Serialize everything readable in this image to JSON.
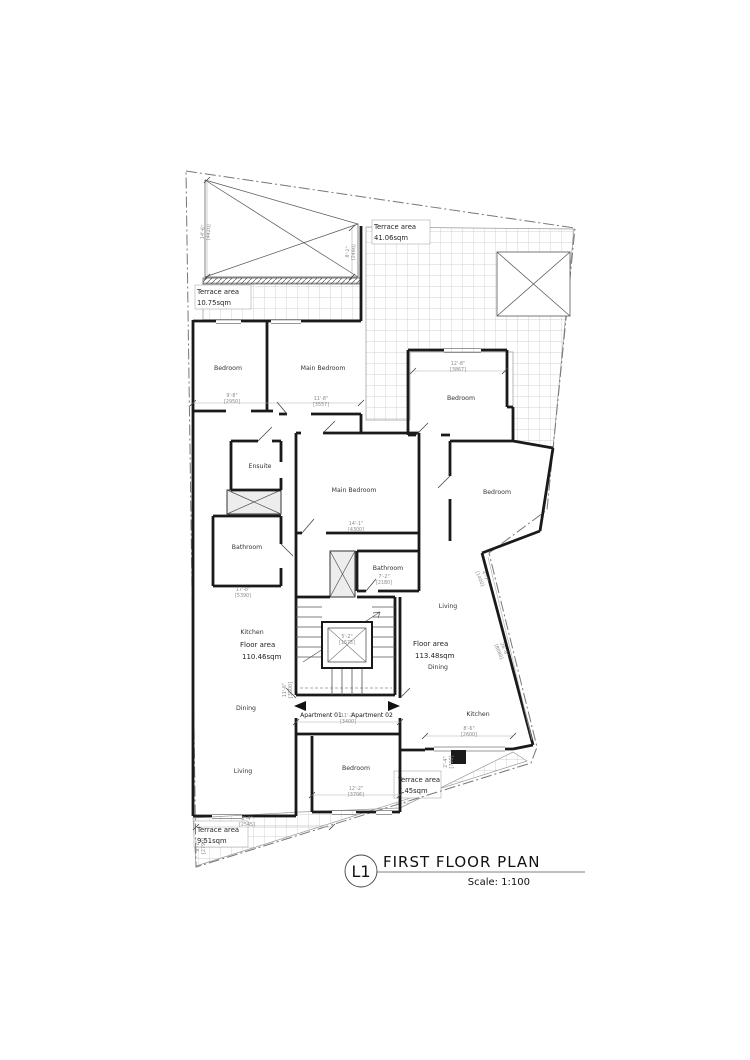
{
  "title_block": {
    "tag": "L1",
    "title": "FIRST FLOOR PLAN",
    "scale": "Scale: 1:100"
  },
  "room_labels": [
    {
      "text": "Bedroom",
      "x": 228,
      "y": 370
    },
    {
      "text": "Main Bedroom",
      "x": 323,
      "y": 370
    },
    {
      "text": "Ensuite",
      "x": 260,
      "y": 468
    },
    {
      "text": "Main Bedroom",
      "x": 354,
      "y": 492
    },
    {
      "text": "Bedroom",
      "x": 461,
      "y": 400
    },
    {
      "text": "Bedroom",
      "x": 497,
      "y": 494
    },
    {
      "text": "Bathroom",
      "x": 247,
      "y": 549
    },
    {
      "text": "Bathroom",
      "x": 388,
      "y": 570
    },
    {
      "text": "Kitchen",
      "x": 252,
      "y": 634
    },
    {
      "text": "Dining",
      "x": 246,
      "y": 710
    },
    {
      "text": "Living",
      "x": 243,
      "y": 773
    },
    {
      "text": "Living",
      "x": 448,
      "y": 608
    },
    {
      "text": "Dining",
      "x": 438,
      "y": 669
    },
    {
      "text": "Kitchen",
      "x": 478,
      "y": 716
    },
    {
      "text": "Bedroom",
      "x": 356,
      "y": 770
    }
  ],
  "area_labels": [
    {
      "line1": "Terrace area",
      "line2": "41.06sqm",
      "x": 374,
      "y": 229
    },
    {
      "line1": "Terrace area",
      "line2": "10.75sqm",
      "x": 197,
      "y": 294
    },
    {
      "line1": "Terrace area",
      "line2": "9.51sqm",
      "x": 197,
      "y": 832
    },
    {
      "line1": "Terrace area",
      "line2": "7.45sqm",
      "x": 398,
      "y": 782
    }
  ],
  "floor_labels": [
    {
      "line1": "Floor area",
      "line2": "110.46sqm",
      "x": 240,
      "y": 647
    },
    {
      "line1": "Floor area",
      "line2": "113.48sqm",
      "x": 413,
      "y": 646
    }
  ],
  "apartment_labels": [
    {
      "text": "Apartment 01",
      "x": 321,
      "y": 717
    },
    {
      "text": "Apartment 02",
      "x": 372,
      "y": 717
    }
  ],
  "dim_labels": [
    {
      "a": "9'-8\"",
      "b": "[2950]",
      "x": 232,
      "y": 397,
      "r": 0
    },
    {
      "a": "11'-8\"",
      "b": "[3557]",
      "x": 321,
      "y": 400,
      "r": 0
    },
    {
      "a": "12'-8\"",
      "b": "[3867]",
      "x": 458,
      "y": 365,
      "r": 0
    },
    {
      "a": "14'-1\"",
      "b": "[4300]",
      "x": 356,
      "y": 525,
      "r": 0
    },
    {
      "a": "17'-8\"",
      "b": "[5390]",
      "x": 243,
      "y": 591,
      "r": 0
    },
    {
      "a": "7'-2\"",
      "b": "[2180]",
      "x": 384,
      "y": 578,
      "r": 0
    },
    {
      "a": "11'-2\"",
      "b": "[3400]",
      "x": 348,
      "y": 717,
      "r": 0
    },
    {
      "a": "12'-2\"",
      "b": "[3706]",
      "x": 356,
      "y": 790,
      "r": 0
    },
    {
      "a": "8'-4\"",
      "b": "[2545]",
      "x": 247,
      "y": 820,
      "r": 0
    },
    {
      "a": "8'-6\"",
      "b": "[2600]",
      "x": 469,
      "y": 730,
      "r": 0
    },
    {
      "a": "5'-2\"",
      "b": "[1575]",
      "x": 347,
      "y": 638,
      "r": 0
    },
    {
      "a": "14'-6\"",
      "b": "[4420]",
      "x": 204,
      "y": 232,
      "r": -87
    },
    {
      "a": "8'-2\"",
      "b": "[2490]",
      "x": 349,
      "y": 252,
      "r": -87
    },
    {
      "a": "26'-6\"",
      "b": "[8080]",
      "x": 503,
      "y": 650,
      "r": 68
    },
    {
      "a": "2'-4\"",
      "b": "[700]",
      "x": 447,
      "y": 762,
      "r": -90
    },
    {
      "a": "4'-7\"",
      "b": "[1400]",
      "x": 484,
      "y": 577,
      "r": 68
    },
    {
      "a": "9'-2\"",
      "b": "[2790]",
      "x": 199,
      "y": 846,
      "r": -90
    },
    {
      "a": "11'-6\"",
      "b": "[3500]",
      "x": 286,
      "y": 690,
      "r": -90
    }
  ]
}
